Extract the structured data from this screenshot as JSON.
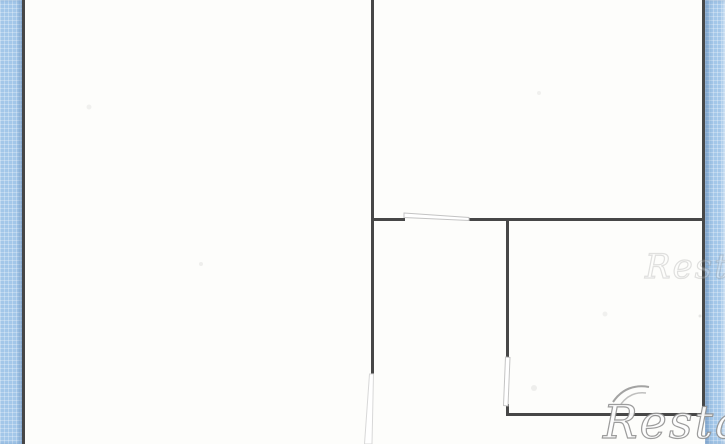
{
  "meta": {
    "width": 725,
    "height": 444
  },
  "watermark": {
    "text": "Restate"
  },
  "colors": {
    "paper": "#fdfdfb",
    "wall": "#474747",
    "margin_blue": "#a3c7e9",
    "door_outline": "#c4c4c4",
    "door_outline_faint": "#d8d8d8",
    "watermark_outline": "#8c8c8c"
  },
  "floorplan": {
    "walls": [
      {
        "name": "outer-wall-left",
        "x": 22,
        "y": 0,
        "w": 3,
        "h": 444
      },
      {
        "name": "outer-wall-right",
        "x": 702,
        "y": 0,
        "w": 3,
        "h": 415
      },
      {
        "name": "interior-wall-vertical-main",
        "x": 371,
        "y": 0,
        "w": 3,
        "h": 375
      },
      {
        "name": "interior-wall-horizontal-left-stub",
        "x": 371,
        "y": 218,
        "w": 34,
        "h": 3
      },
      {
        "name": "interior-wall-horizontal-right-run",
        "x": 468,
        "y": 218,
        "w": 237,
        "h": 3
      },
      {
        "name": "interior-wall-vertical-right-upper",
        "x": 506,
        "y": 221,
        "w": 3,
        "h": 137
      },
      {
        "name": "interior-wall-vertical-right-lower",
        "x": 506,
        "y": 404,
        "w": 3,
        "h": 12
      },
      {
        "name": "interior-wall-horizontal-bottom",
        "x": 506,
        "y": 413,
        "w": 199,
        "h": 3
      }
    ],
    "doors": [
      {
        "name": "door-leaf-top-opening",
        "points": "404,213 469,217.5 469,220.5 404,217.5",
        "faint": false
      },
      {
        "name": "door-leaf-right-opening",
        "points": "505.5,357 510,357.5 508,406 503.5,405.5",
        "faint": false
      },
      {
        "name": "door-leaf-bottom-opening",
        "points": "369.5,374 373.5,374 372,444 364.5,444",
        "faint": true
      }
    ],
    "smudges": [
      {
        "x": 89,
        "y": 107,
        "r": 2.5,
        "o": 0.1
      },
      {
        "x": 201,
        "y": 264,
        "r": 2.0,
        "o": 0.12
      },
      {
        "x": 539,
        "y": 93,
        "r": 2.0,
        "o": 0.1
      },
      {
        "x": 605,
        "y": 314,
        "r": 2.5,
        "o": 0.1
      },
      {
        "x": 700,
        "y": 316,
        "r": 1.5,
        "o": 0.18
      },
      {
        "x": 534,
        "y": 388,
        "r": 3.0,
        "o": 0.12
      }
    ]
  }
}
